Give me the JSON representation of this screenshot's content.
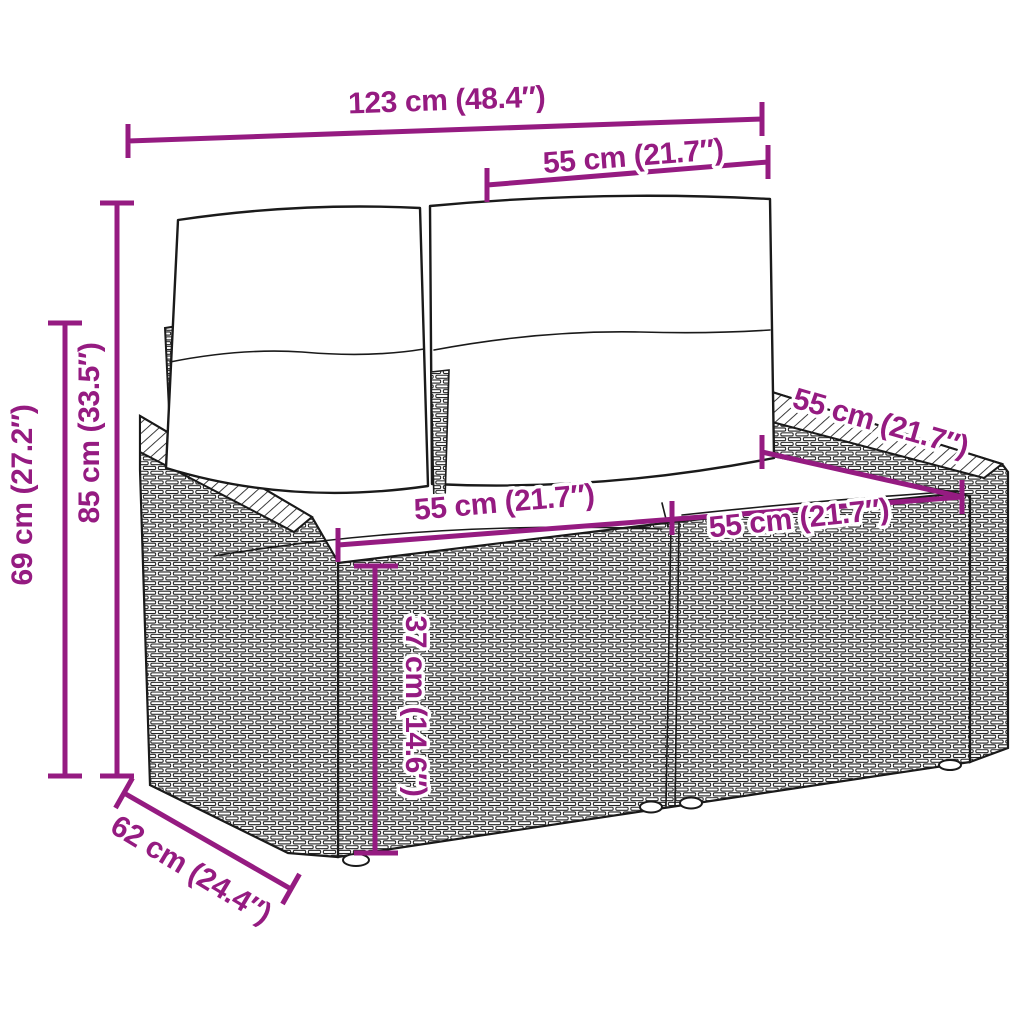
{
  "diagram": {
    "subject": "poly-rattan two-seater garden bench with back and seat cushions, isometric line drawing with dimension callouts",
    "accent_color": "#951b81",
    "line_color": "#1a1a1a",
    "background_color": "#ffffff",
    "dimensions": [
      {
        "id": "total-width",
        "label": "123 cm (48.4″)",
        "value_cm": 123,
        "value_in": 48.4
      },
      {
        "id": "backrest-width",
        "label": "55 cm (21.7″)",
        "value_cm": 55,
        "value_in": 21.7
      },
      {
        "id": "total-height",
        "label": "85 cm (33.5″)",
        "value_cm": 85,
        "value_in": 33.5
      },
      {
        "id": "armrest-height",
        "label": "69 cm (27.2″)",
        "value_cm": 69,
        "value_in": 27.2
      },
      {
        "id": "seat-width-left",
        "label": "55 cm (21.7″)",
        "value_cm": 55,
        "value_in": 21.7
      },
      {
        "id": "seat-width-right",
        "label": "55 cm (21.7″)",
        "value_cm": 55,
        "value_in": 21.7
      },
      {
        "id": "seat-depth",
        "label": "55 cm (21.7″)",
        "value_cm": 55,
        "value_in": 21.7
      },
      {
        "id": "seat-height",
        "label": "37 cm (14.6″)",
        "value_cm": 37,
        "value_in": 14.6
      },
      {
        "id": "base-depth",
        "label": "62 cm (24.4″)",
        "value_cm": 62,
        "value_in": 24.4
      }
    ]
  }
}
